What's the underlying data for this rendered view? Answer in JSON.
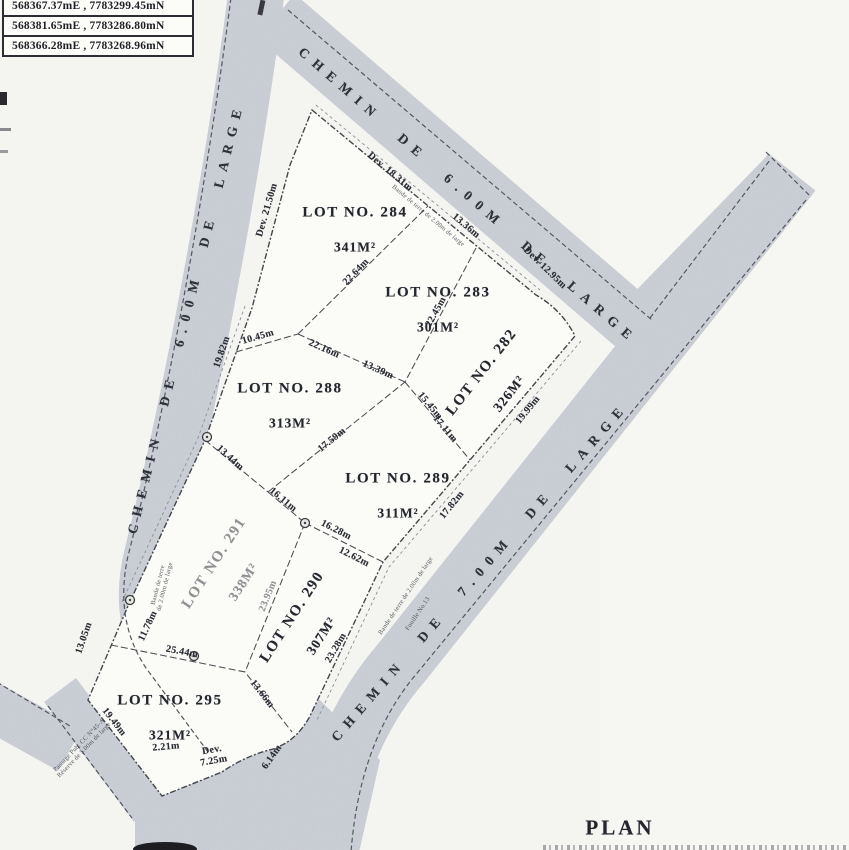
{
  "plan": {
    "title": "PLAN"
  },
  "coordinates_table": {
    "rows": [
      "568367.37mE , 7783299.45mN",
      "568381.65mE , 7783286.80mN",
      "568366.28mE , 7783268.96mN"
    ]
  },
  "roads": {
    "top_label": "CHEMIN DE 6.00M DE LARGE",
    "left_label": "CHEMIN DE 6.00M DE LARGE",
    "right_label": "CHEMIN DE 7.00M DE LARGE"
  },
  "lots": {
    "lot284": {
      "name": "LOT NO. 284",
      "area": "341M²"
    },
    "lot283": {
      "name": "LOT NO. 283",
      "area": "301M²"
    },
    "lot282": {
      "name": "LOT NO. 282",
      "area": "326M²"
    },
    "lot288": {
      "name": "LOT NO. 288",
      "area": "313M²"
    },
    "lot289": {
      "name": "LOT NO. 289",
      "area": "311M²"
    },
    "lot290": {
      "name": "LOT NO. 290",
      "area": "307M²"
    },
    "lot291": {
      "name": "LOT NO. 291",
      "area": "338M²"
    },
    "lot295": {
      "name": "LOT NO. 295",
      "area": "321M²"
    }
  },
  "dimensions": {
    "dev_21_50": "Dev. 21.50m",
    "d19_82": "19.82m",
    "dev_18_31": "Dev. 18.31m",
    "d13_36": "13.36m",
    "dev_12_95": "Dev. 12.95m",
    "d22_64": "22.64m",
    "d10_45": "10.45m",
    "d22_16": "22.16m",
    "d13_39": "13.39m",
    "d22_45": "22.45m",
    "d19_99": "19.99m",
    "d15_45": "15.45m",
    "d17_11": "17.11m",
    "d17_59": "17.59m",
    "d13_44": "13.44m",
    "d16_11": "16.11m",
    "d16_28": "16.28m",
    "d12_62": "12.62m",
    "d17_82": "17.82m",
    "d23_95": "23.95m",
    "d11_78": "11.78m",
    "d13_05": "13.05m",
    "d25_44": "25.44m",
    "d13_66": "13.66m",
    "d23_28": "23.28m",
    "d19_49": "19.49m",
    "d2_21": "2.21m",
    "dev_7_25": "Dev.\n7.25m",
    "d6_14": "6.14m"
  },
  "notes": {
    "top_road_strip": "Bande de terre de 2.00m de large",
    "right_road_strip": "Bande de terre de 2.00m de large",
    "right_road_strip2": "Fouille No.13",
    "left_road_strip": "Bande de terre\nde 2.00m de large",
    "passage_strip": "Passage Pub. CC N°45-A\nRéserve de 5.00m de large"
  },
  "colors": {
    "road_fill": "#ced2d8",
    "paper": "#f4f4f1",
    "lot_fill": "#fbfbf8",
    "line": "#4a4d53"
  }
}
